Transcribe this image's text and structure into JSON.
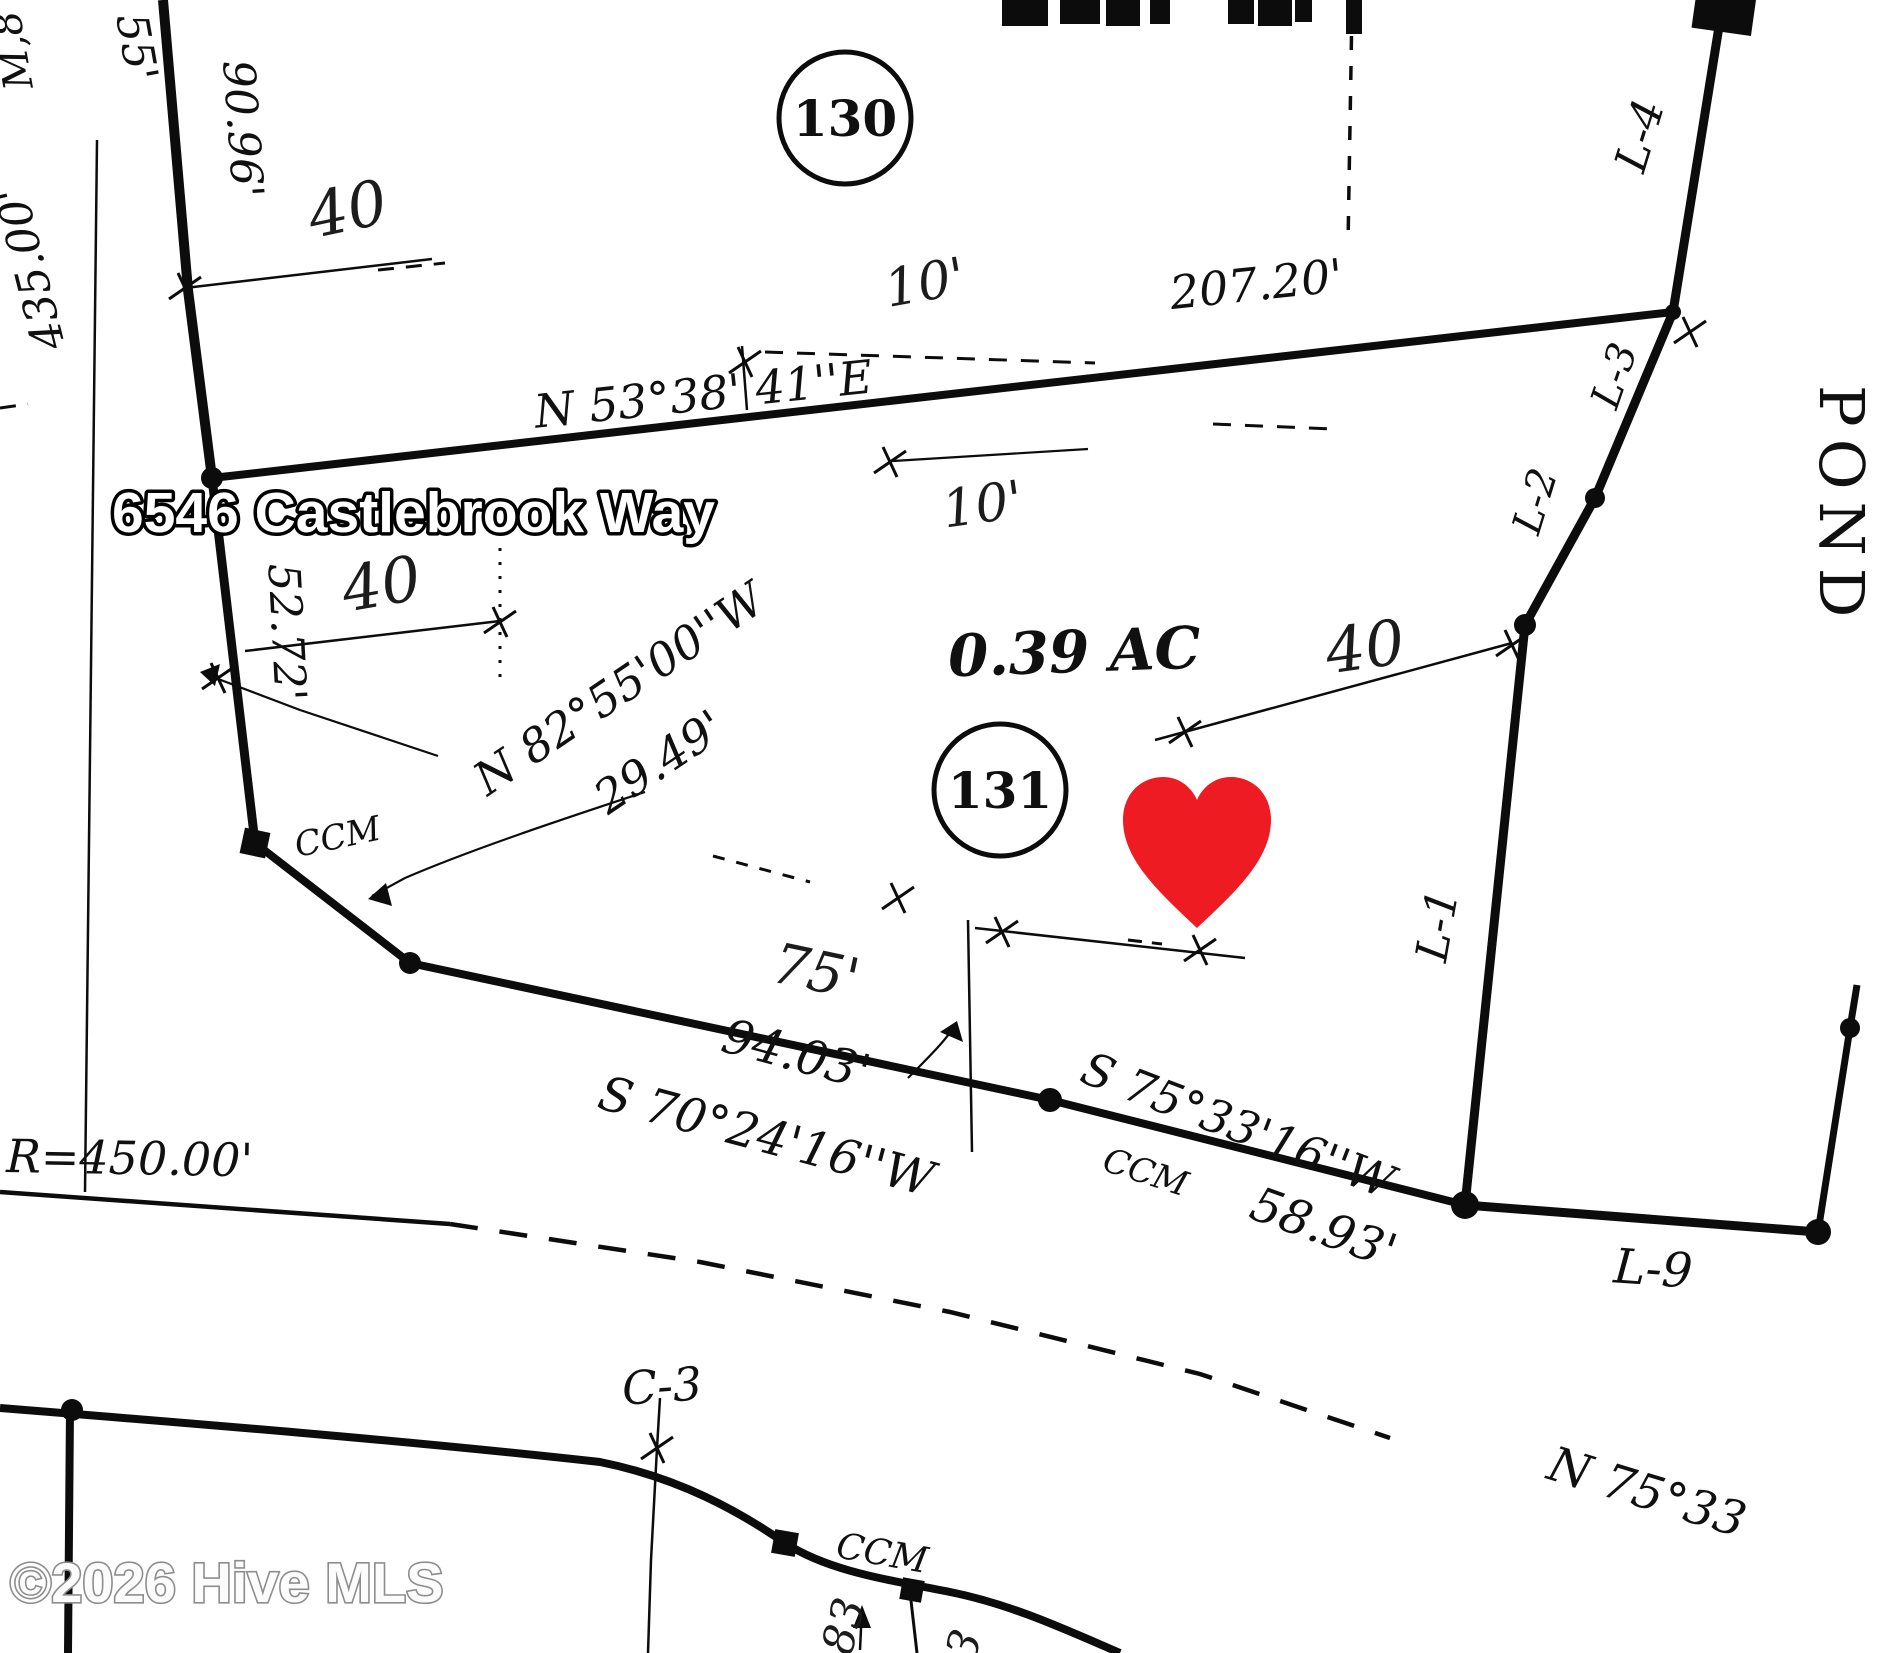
{
  "key_facts": {
    "address_overlay": "6546 Castlebrook Way",
    "lot_area": "0.39 AC",
    "lot_numbers": [
      "130",
      "131"
    ],
    "watermark": "©2026 Hive MLS"
  },
  "colors": {
    "heart": "#ee1b22",
    "ink": "#0c0c0c",
    "watermark_gray": "#8d8d8d"
  },
  "labels": [
    {
      "name": "address-overlay",
      "text": "6546 Castlebrook Way",
      "x": 112,
      "y": 532,
      "rot": 0,
      "size": 57,
      "cls": "addr",
      "anchor": "start"
    },
    {
      "name": "watermark-text",
      "text": "©2026 Hive MLS",
      "x": 10,
      "y": 1602,
      "rot": 0,
      "size": 56,
      "cls": "wm",
      "anchor": "start"
    },
    {
      "name": "lot-area",
      "text": "0.39 AC",
      "x": 1075,
      "y": 672,
      "rot": -2,
      "size": 58,
      "cls": "srvB"
    },
    {
      "name": "lot-number-130",
      "text": "130",
      "x": 845,
      "y": 136,
      "rot": 0,
      "size": 50,
      "cls": "lot"
    },
    {
      "name": "lot-number-131",
      "text": "131",
      "x": 1000,
      "y": 808,
      "rot": 0,
      "size": 50,
      "cls": "lot"
    },
    {
      "name": "pond-label",
      "text": "POND",
      "x": 1820,
      "y": 385,
      "rot": 90,
      "size": 62,
      "cls": "pond",
      "anchor": "start"
    },
    {
      "name": "bearing-north-line",
      "text": "N 53°38' 41''E",
      "x": 705,
      "y": 410,
      "rot": -6,
      "size": 46,
      "cls": "srv"
    },
    {
      "name": "distance-north-line",
      "text": "207.20'",
      "x": 1258,
      "y": 300,
      "rot": -6,
      "size": 46,
      "cls": "srv"
    },
    {
      "name": "distance-west",
      "text": "52.72'",
      "x": 272,
      "y": 633,
      "rot": 87,
      "size": 44,
      "cls": "srv"
    },
    {
      "name": "distance-9096",
      "text": "90.96'",
      "x": 228,
      "y": 130,
      "rot": 86,
      "size": 44,
      "cls": "srv"
    },
    {
      "name": "distance-55",
      "text": "55'",
      "x": 122,
      "y": 50,
      "rot": 80,
      "size": 44,
      "cls": "srv"
    },
    {
      "name": "distance-435",
      "text": "435.00'",
      "x": 45,
      "y": 265,
      "rot": -104,
      "size": 44,
      "cls": "srv"
    },
    {
      "name": "edge-text-m8",
      "text": "M,8",
      "x": 26,
      "y": 48,
      "rot": -100,
      "size": 40,
      "cls": "srv"
    },
    {
      "name": "bearing-n82",
      "text": "N 82°55'00''W",
      "x": 628,
      "y": 702,
      "rot": -34,
      "size": 46,
      "cls": "srv"
    },
    {
      "name": "distance-2949",
      "text": "29.49'",
      "x": 668,
      "y": 775,
      "rot": -34,
      "size": 46,
      "cls": "srv"
    },
    {
      "name": "bearing-s70",
      "text": "S 70°24'16''W",
      "x": 762,
      "y": 1152,
      "rot": 15,
      "size": 48,
      "cls": "srv"
    },
    {
      "name": "distance-9403",
      "text": "94.03'",
      "x": 792,
      "y": 1070,
      "rot": 15,
      "size": 48,
      "cls": "srv"
    },
    {
      "name": "bearing-s75",
      "text": "S 75°33'16''W",
      "x": 1232,
      "y": 1140,
      "rot": 21,
      "size": 46,
      "cls": "srv"
    },
    {
      "name": "ccm-label-south",
      "text": "CCM",
      "x": 1142,
      "y": 1183,
      "rot": 18,
      "size": 34,
      "cls": "srv"
    },
    {
      "name": "distance-5893",
      "text": "58.93'",
      "x": 1318,
      "y": 1243,
      "rot": 20,
      "size": 48,
      "cls": "srv"
    },
    {
      "name": "ccm-label-west",
      "text": "CCM",
      "x": 340,
      "y": 848,
      "rot": -12,
      "size": 34,
      "cls": "srv"
    },
    {
      "name": "ccm-label-road",
      "text": "CCM",
      "x": 880,
      "y": 1565,
      "rot": 10,
      "size": 36,
      "cls": "srv"
    },
    {
      "name": "radius-label",
      "text": "R=450.00'",
      "x": 6,
      "y": 1172,
      "rot": 1,
      "size": 46,
      "cls": "srv",
      "anchor": "start"
    },
    {
      "name": "line-label-l9",
      "text": "L-9",
      "x": 1652,
      "y": 1285,
      "rot": 4,
      "size": 48,
      "cls": "srv"
    },
    {
      "name": "line-label-l1",
      "text": "L-1",
      "x": 1452,
      "y": 928,
      "rot": -80,
      "size": 44,
      "cls": "srv"
    },
    {
      "name": "line-label-l2",
      "text": "L-2",
      "x": 1548,
      "y": 505,
      "rot": -73,
      "size": 40,
      "cls": "srv"
    },
    {
      "name": "line-label-l3",
      "text": "L-3",
      "x": 1627,
      "y": 380,
      "rot": -71,
      "size": 40,
      "cls": "srv"
    },
    {
      "name": "line-label-l4",
      "text": "L-4",
      "x": 1654,
      "y": 140,
      "rot": -73,
      "size": 44,
      "cls": "srv"
    },
    {
      "name": "curve-label-c3",
      "text": "C-3",
      "x": 663,
      "y": 1402,
      "rot": -4,
      "size": 46,
      "cls": "srv"
    },
    {
      "name": "bearing-n75-road",
      "text": "N 75°33",
      "x": 1545,
      "y": 1478,
      "rot": 17,
      "size": 48,
      "cls": "srv",
      "anchor": "start"
    },
    {
      "name": "setback-40-upperleft",
      "text": "40",
      "x": 352,
      "y": 230,
      "rot": -12,
      "size": 62,
      "cls": "hand"
    },
    {
      "name": "setback-40-left",
      "text": "40",
      "x": 385,
      "y": 605,
      "rot": -10,
      "size": 62,
      "cls": "hand"
    },
    {
      "name": "setback-40-right",
      "text": "40",
      "x": 1368,
      "y": 668,
      "rot": -8,
      "size": 62,
      "cls": "hand"
    },
    {
      "name": "setback-10-upper",
      "text": "10'",
      "x": 928,
      "y": 300,
      "rot": -10,
      "size": 52,
      "cls": "hand"
    },
    {
      "name": "setback-10-mid",
      "text": "10'",
      "x": 985,
      "y": 522,
      "rot": -8,
      "size": 52,
      "cls": "hand"
    },
    {
      "name": "setback-75",
      "text": "75'",
      "x": 812,
      "y": 990,
      "rot": 12,
      "size": 56,
      "cls": "hand"
    },
    {
      "name": "hand-mark-83",
      "text": "83",
      "x": 858,
      "y": 1630,
      "rot": -75,
      "size": 44,
      "cls": "hand"
    },
    {
      "name": "hand-mark-3",
      "text": "3",
      "x": 978,
      "y": 1650,
      "rot": -70,
      "size": 44,
      "cls": "hand"
    }
  ]
}
